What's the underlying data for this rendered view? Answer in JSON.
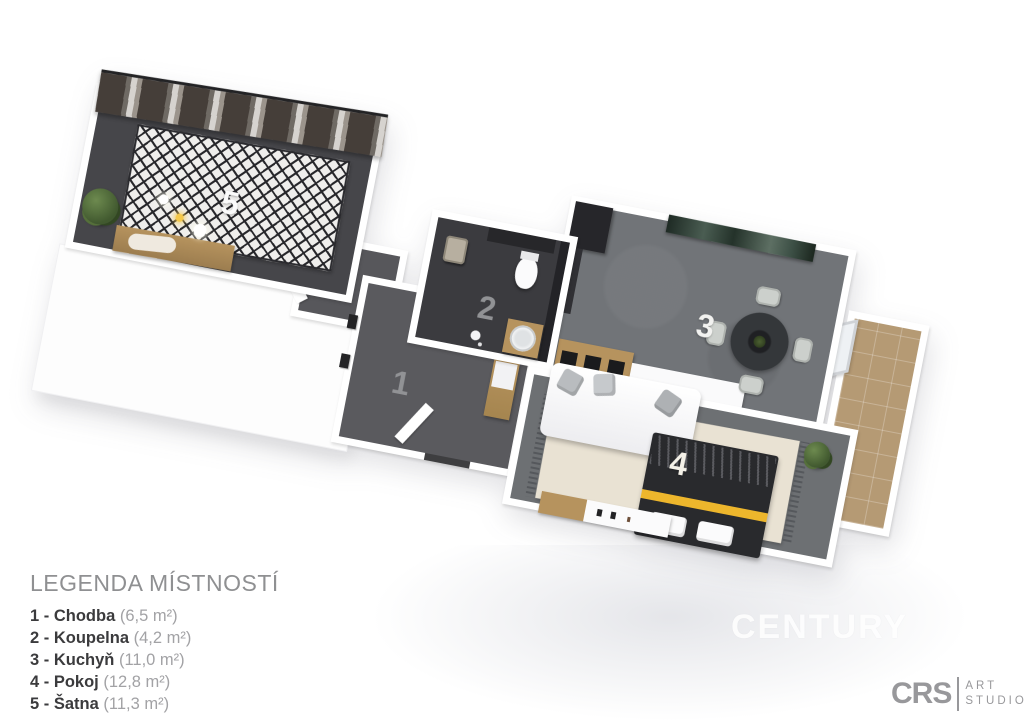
{
  "plan": {
    "rooms": [
      {
        "number": "1",
        "name": "Chodba"
      },
      {
        "number": "2",
        "name": "Koupelna"
      },
      {
        "number": "3",
        "name": "Kuchyň"
      },
      {
        "number": "4",
        "name": "Pokoj"
      },
      {
        "number": "5",
        "name": "Šatna"
      }
    ]
  },
  "legend": {
    "title": "LEGENDA MÍSTNOSTÍ",
    "items": [
      {
        "label": "1 - Chodba",
        "area": "(6,5 m²)"
      },
      {
        "label": "2 - Koupelna",
        "area": "(4,2 m²)"
      },
      {
        "label": "3 - Kuchyň",
        "area": "(11,0 m²)"
      },
      {
        "label": "4 - Pokoj",
        "area": "(12,8 m²)"
      },
      {
        "label": "5 - Šatna",
        "area": "(11,3 m²)"
      }
    ],
    "footnote": "*Plocha místností je pouze orientační"
  },
  "watermark": "CENTURY",
  "logo": {
    "brand": "CRS",
    "line1": "ART",
    "line2": "STUDIO"
  },
  "colors": {
    "wall_white": "#ffffff",
    "floor_wardrobe": "#46464a",
    "floor_corridor": "#57575b",
    "floor_hallway": "#5a5a5e",
    "floor_bathroom": "#3b3b3f",
    "floor_kitchen": "#717478",
    "floor_bedroom": "#6d7073",
    "balcony_tile": "#b59a74",
    "rug_cream": "#e9e2d3",
    "rug_black": "#26262a",
    "rug_white": "#efeeec",
    "wood": "#b6935e",
    "bed_dark": "#292a2d",
    "bed_yellow": "#edb62c",
    "painting_teal": "#3c4f45",
    "furniture_dark": "#26262a",
    "pillow_gray": "#b9bcbf",
    "plant_green": "#41592f",
    "number_light": "#f2f2f0",
    "number_gray": "#919295",
    "legend_title": "#8f9092",
    "legend_text": "#3b3b3d",
    "legend_area": "#a2a2a5",
    "footnote": "#b6b6b9",
    "logo_gray": "#98989b",
    "watermark": "#ffffff"
  }
}
